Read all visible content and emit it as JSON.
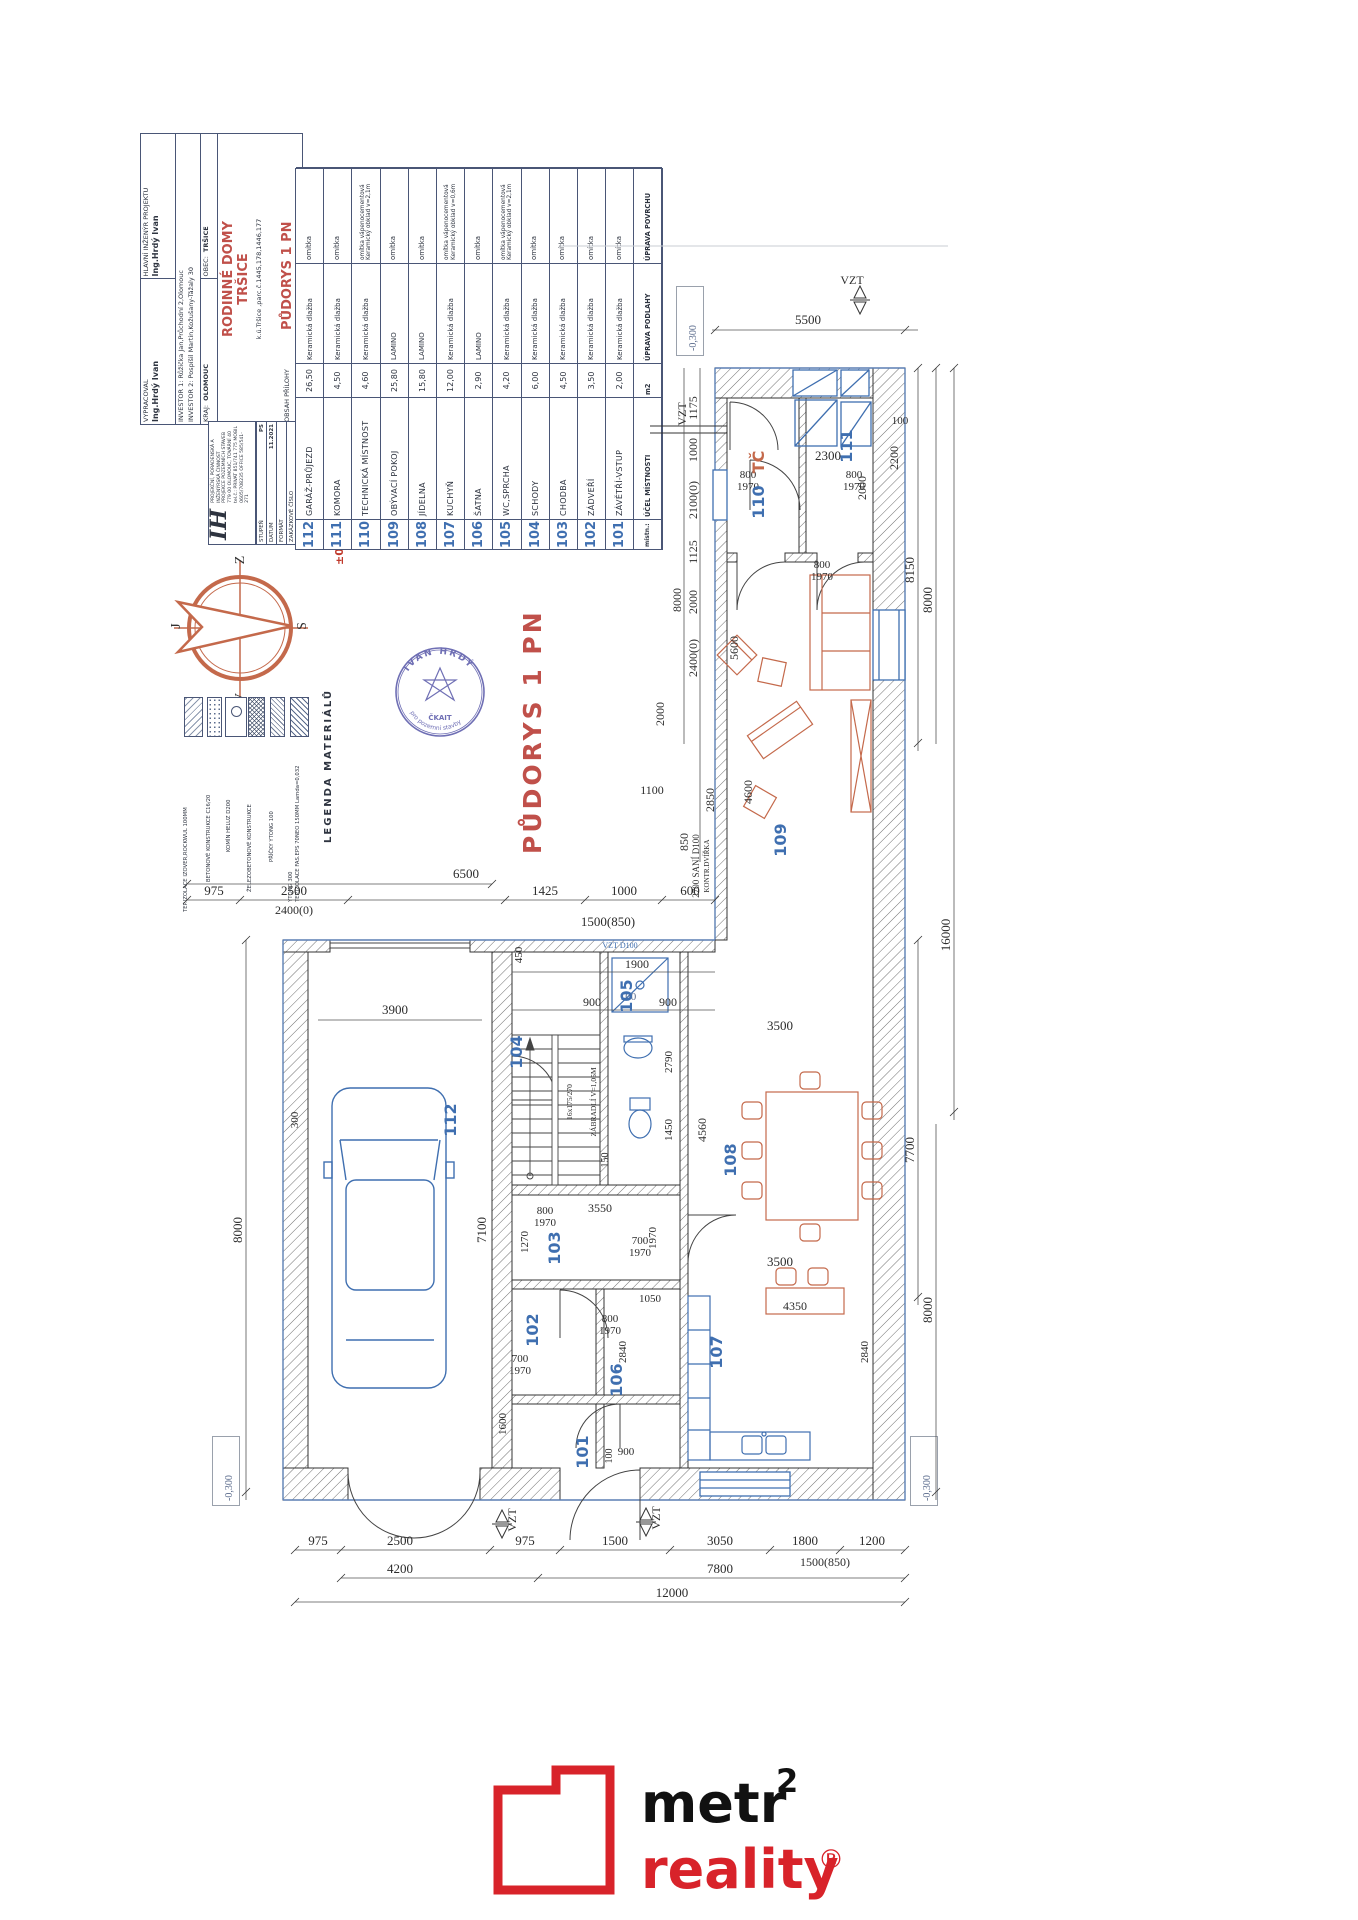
{
  "title_block": {
    "vypracoval_label": "VYPRACOVAL",
    "vypracoval_value": "Ing.Hrdý Ivan",
    "engineer_label": "HLAVNÍ INŽENÝR PROJEKTU",
    "engineer_value": "Ing.Hrdý Ivan",
    "investor1": "INVESTOR 1:  Růžička Jan,Průchodní 2,Olomouc",
    "investor2": "INVESTOR 2:  Pospíšil Martin,Kožušany-Tážaly 30",
    "kraj_label": "KRAJ:",
    "kraj_value": "OLOMOUC",
    "obec_label": "OBEC:",
    "obec_value": "TRŠICE",
    "project_line1": "RODINNÉ DOMY",
    "project_line2": "TRŠICE",
    "parcel": "k.ú.Tršice ,parc.č.1445,178,1446,177",
    "obsah_label": "OBSAH PŘÍLOHY",
    "obsah_value": "PŮDORYS 1 PN",
    "stupen_label": "STUPEŇ",
    "stupen_value": "PS",
    "datum_label": "DATUM",
    "datum_value": "11.2021",
    "format_label": "FORMÁT",
    "zakazka_label": "ZAKÁZKOVÉ ČÍSLO",
    "meritko_label": "MĚŘÍTKO",
    "meritko_value": "1:50",
    "cislo_label": "ČÍSLO PŘÍLOHY",
    "cislo_value": "D 1.1.04",
    "firm_initials": "IH",
    "firm_line1": "PROJEKČNÍ, PORADENSKÁ A INŽENÝRSKÁ ČINNOST",
    "firm_line2": "PROJEKCE POZEMNÍCH STAVEB",
    "firm_line3": "779 00 OLOMOUC, TOVÁRNÍ 40",
    "firm_line4": "tel.č.: PRIVAT 851/741 775  MOBIL 0605/708235  OFFICE 585/541-271",
    "elevation": "±0,00=265,50m.n.m"
  },
  "room_table": {
    "headers": [
      "místn.:",
      "ÚČEL MÍSTNOSTI",
      "m2",
      "ÚPRAVA PODLAHY",
      "ÚPRAVA POVRCHU"
    ],
    "rows": [
      {
        "num": "101",
        "name": "ZÁVĚTŘÍ-VSTUP",
        "area": "2,00",
        "floor": "Keramická dlažba",
        "surface": "omítka",
        "surface2": ""
      },
      {
        "num": "102",
        "name": "ZÁDVEŘÍ",
        "area": "3,50",
        "floor": "Keramická dlažba",
        "surface": "omítka",
        "surface2": ""
      },
      {
        "num": "103",
        "name": "CHODBA",
        "area": "4,50",
        "floor": "Keramická dlažba",
        "surface": "omítka",
        "surface2": ""
      },
      {
        "num": "104",
        "name": "SCHODY",
        "area": "6,00",
        "floor": "Keramická dlažba",
        "surface": "omítka",
        "surface2": ""
      },
      {
        "num": "105",
        "name": "WC,SPRCHA",
        "area": "4,20",
        "floor": "Keramická dlažba",
        "surface": "omítka vápenocementová",
        "surface2": "Keramický obklad v=2,1m"
      },
      {
        "num": "106",
        "name": "ŠATNA",
        "area": "2,90",
        "floor": "LAMINO",
        "surface": "omítka",
        "surface2": ""
      },
      {
        "num": "107",
        "name": "KUCHYŇ",
        "area": "12,00",
        "floor": "Keramická dlažba",
        "surface": "omítka vápenocementová",
        "surface2": "Keramický obklad v=0,6m"
      },
      {
        "num": "108",
        "name": "JÍDELNA",
        "area": "15,80",
        "floor": "LAMINO",
        "surface": "omítka",
        "surface2": ""
      },
      {
        "num": "109",
        "name": "OBÝVACÍ POKOJ",
        "area": "25,80",
        "floor": "LAMINO",
        "surface": "omítka",
        "surface2": ""
      },
      {
        "num": "110",
        "name": "TECHNICKÁ MÍSTNOST",
        "area": "4,60",
        "floor": "Keramická dlažba",
        "surface": "omítka vápenocementová",
        "surface2": "Keramický obklad v=2,1m"
      },
      {
        "num": "111",
        "name": "KOMORA",
        "area": "4,50",
        "floor": "Keramická dlažba",
        "surface": "omítka",
        "surface2": ""
      },
      {
        "num": "112",
        "name": "GARÁŽ-PRŮJEZD",
        "area": "26,50",
        "floor": "Keramická dlažba",
        "surface": "omítka",
        "surface2": ""
      }
    ]
  },
  "legend": {
    "title": "LEGENDA MATERIÁLŮ",
    "items": [
      {
        "label": "YTONG 300",
        "label2": "TEP.IZOLACE FAS.EPS 70NEO 150MM Lamda=0,032"
      },
      {
        "label": "PŘÍČKY YTONG 100",
        "label2": ""
      },
      {
        "label": "ŽELEZOBETONOVÉ KONSTRUKCE",
        "label2": ""
      },
      {
        "label": "KOMÍN HELUZ D200",
        "label2": ""
      },
      {
        "label": "BETONOVÉ KONSTRUKCE C16/20",
        "label2": ""
      },
      {
        "label": "TEP.IZOLACE IZOVER,ROCKWUL 100MM",
        "label2": ""
      }
    ]
  },
  "compass": {
    "top": "Z",
    "right": "S",
    "left": "J",
    "bottom": "V"
  },
  "stamp": {
    "name": "IVAN HRDÝ",
    "line": "pro pozemní stavby",
    "org": "ČKAIT"
  },
  "drawing_title": "PŮDORYS 1 PN",
  "elevation_box": "-0,300",
  "plan": {
    "rooms": {
      "r101": "101",
      "r102": "102",
      "r103": "103",
      "r104": "104",
      "r105": "105",
      "r106": "106",
      "r107": "107",
      "r108": "108",
      "r109": "109",
      "r110": "110",
      "r111": "111",
      "r112": "112"
    },
    "labels": {
      "tc": "TČ",
      "vzt": "VZT",
      "vzt_d100": "VZT D100",
      "sani": "2700 SANÍ D100",
      "kontr": "KONTR.DVÍŘKA",
      "zabradli": "ZÁBRADLÍ V=1,05M",
      "steps": "16x175/270"
    },
    "dims": {
      "t5500": "5500",
      "r8150": "8150",
      "r8000a": "8000",
      "r16000": "16000",
      "r7700": "7700",
      "r8000b": "8000",
      "b975a": "975",
      "b2500": "2500",
      "b975b": "975",
      "b1500": "1500",
      "b3050": "3050",
      "b1800": "1800",
      "b1200": "1200",
      "b4200": "4200",
      "b7800": "7800",
      "b1500_850": "1500(850)",
      "b12000": "12000",
      "m6500": "6500",
      "m975": "975",
      "m2500": "2500",
      "m2400_0": "2400(0)",
      "m1425": "1425",
      "m1000": "1000",
      "m600": "600",
      "m1500_850": "1500(850)",
      "m450": "450",
      "m1900": "1900",
      "m900": "900",
      "m100": "100",
      "l8000": "8000",
      "l300": "300",
      "l3900": "3900",
      "l7100": "7100",
      "l1600": "1600",
      "u1175": "1175",
      "u1000": "1000",
      "u2100_0": "2100(0)",
      "u1125": "1125",
      "u2000a": "2000",
      "u2400_0": "2400(0)",
      "u8000": "8000",
      "i2300": "2300",
      "i2000": "2000",
      "i100": "100",
      "i2200": "2200",
      "i5600": "5600",
      "i4600": "4600",
      "i2850": "2850",
      "i1100": "1100",
      "i850": "850",
      "i2000c": "2000",
      "d800": "800",
      "d700": "700",
      "d1970": "1970",
      "w2790": "2790",
      "w1450": "1450",
      "w150": "150",
      "w1270": "1270",
      "w3550": "3550",
      "w1970": "1970",
      "w3500": "3500",
      "w4560": "4560",
      "w4350": "4350",
      "w2840": "2840",
      "w1050": "1050",
      "w900": "900",
      "w100": "100"
    }
  },
  "brand": {
    "word1": "metr",
    "sup": "2",
    "word2": "reality",
    "reg": "®"
  }
}
